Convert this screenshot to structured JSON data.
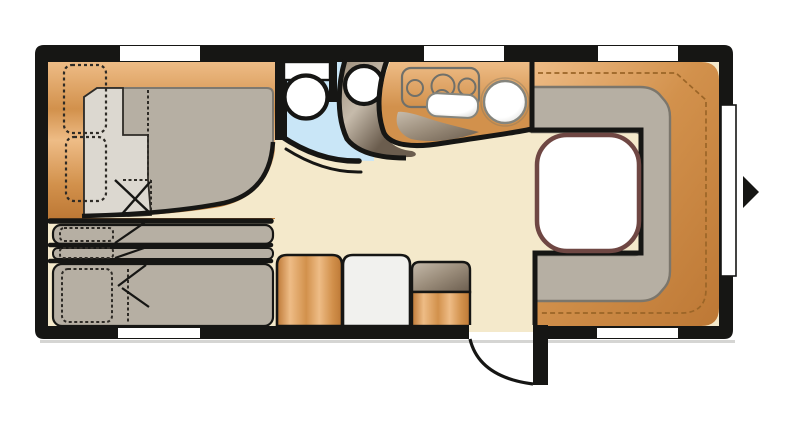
{
  "figure": {
    "type": "floorplan",
    "subject": "Caravan / travel-trailer interior layout, top-down view",
    "elements": [
      "front double bed with two pillows and fold-out section",
      "three stacked bunk beds",
      "bathroom with toilet, blue floor and corner shower",
      "kitchen block with 3-burner hob, sink and round basin",
      "U-shaped rear dinette with white table",
      "entrance door with swing arc",
      "wardrobe cabinet, fridge cabinet and step unit",
      "five windows and one side window",
      "entrance direction arrow"
    ]
  },
  "palette": {
    "page_bg": "#ffffff",
    "ink": "#161614",
    "floor": "#f4e9cb",
    "window": "#ffffff",
    "shadow": "#b9b9b5",
    "bath_floor": "#c9e6f7",
    "white": "#ffffff",
    "near_white": "#f1f1ee",
    "cushion": "#b6afa3",
    "cushion_line": "#7b766c",
    "mattress_edge": "#7e7970",
    "pad_light": "#dcd8d0",
    "dash_dark": "#2e2b26",
    "wood_light": "#eebc86",
    "wood_mid": "#d2914c",
    "wood_dark": "#bd7835",
    "wood_dash": "#9b6527",
    "shower_light": "#c6bbab",
    "shower_mid": "#9a8c7a",
    "shower_dark": "#6b5d4e",
    "stove_line": "#70706a",
    "fixture_line": "#85857d",
    "sink_shade": "#d9d9d6",
    "basin_ring": "#8a7a60",
    "table_line": "#6f4743"
  }
}
